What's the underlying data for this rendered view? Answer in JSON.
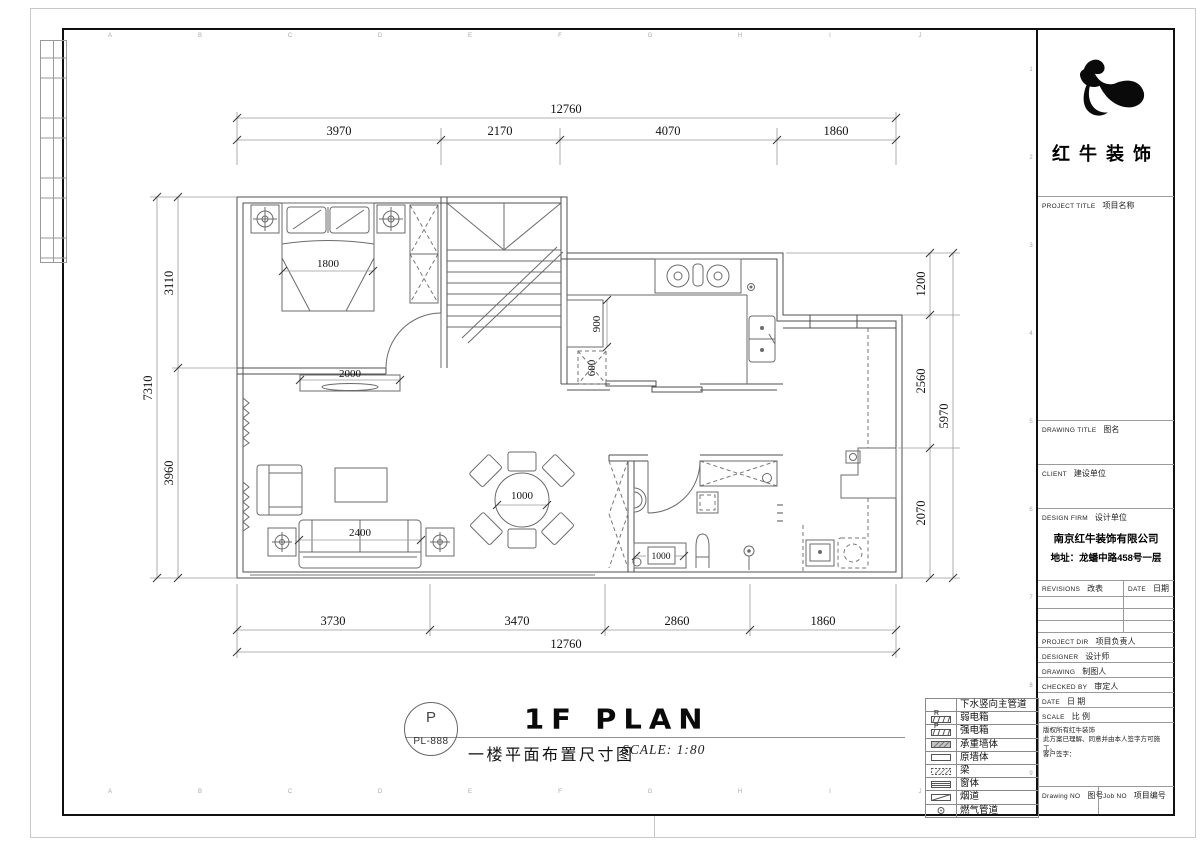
{
  "brand": {
    "name": "红牛装饰"
  },
  "title_block": {
    "project_title_en": "PROJECT TITLE",
    "project_title_cn": "项目名称",
    "drawing_title_en": "DRAWING TITLE",
    "drawing_title_cn": "图名",
    "client_en": "CLIENT",
    "client_cn": "建设单位",
    "design_firm_en": "DESIGN FIRM",
    "design_firm_cn": "设计单位",
    "firm_name": "南京红牛装饰有限公司",
    "firm_address": "地址：龙蟠中路458号一层",
    "revisions_en": "REVISIONS",
    "revisions_cn": "改表",
    "rev_date_en": "DATE",
    "rev_date_cn": "日期",
    "staff_rows": [
      {
        "en": "PROJECT DIR",
        "cn": "项目负责人"
      },
      {
        "en": "DESIGNER",
        "cn": "设计师"
      },
      {
        "en": "DRAWING",
        "cn": "制图人"
      },
      {
        "en": "CHECKED BY",
        "cn": "审定人"
      },
      {
        "en": "DATE",
        "cn": "日 期"
      },
      {
        "en": "SCALE",
        "cn": "比 例"
      }
    ],
    "copyright_line1": "版权所有红牛装饰",
    "copyright_line2": "此方案已理解、同意并由本人签字方可施工。",
    "customer_sign": "客户签字：",
    "drawing_no_en": "Drawing NO",
    "drawing_no_cn": "图号",
    "job_no_en": "Job NO",
    "job_no_cn": "项目编号"
  },
  "legend": {
    "items": [
      {
        "label": "下水竖向主管道",
        "letter": ""
      },
      {
        "label": "弱电箱",
        "letter": "R"
      },
      {
        "label": "强电箱",
        "letter": "P"
      },
      {
        "label": "承重墙体",
        "letter": ""
      },
      {
        "label": "原墙体",
        "letter": ""
      },
      {
        "label": "梁",
        "letter": ""
      },
      {
        "label": "窗体",
        "letter": ""
      },
      {
        "label": "烟道",
        "letter": ""
      },
      {
        "label": "燃气管道",
        "letter": ""
      }
    ]
  },
  "title_bar": {
    "stamp_letter": "P",
    "stamp_code": "PL-888",
    "title_en": "1F PLAN",
    "title_cn": "一楼平面布置尺寸图",
    "scale_label": "SCALE: 1:80"
  },
  "dimensions": {
    "top_total": "12760",
    "top": [
      "3970",
      "2170",
      "4070",
      "1860"
    ],
    "bottom": [
      "3730",
      "3470",
      "2860",
      "1860"
    ],
    "bottom_total": "12760",
    "left": [
      "3110",
      "3960"
    ],
    "left_total": "7310",
    "right": [
      "1200",
      "2560",
      "2070"
    ],
    "right_total": "5970",
    "bed": "1800",
    "tv_wall": "2000",
    "sofa": "2400",
    "dining_table": "1000",
    "kitchen_counter": "900",
    "kitchen_cabinet": "600",
    "bath_vanity": "1000"
  },
  "grid": {
    "letters": [
      "A",
      "B",
      "C",
      "D",
      "E",
      "F",
      "G",
      "H",
      "I",
      "J"
    ],
    "numbers": [
      "1",
      "2",
      "3",
      "4",
      "5",
      "6",
      "7",
      "8",
      "9"
    ]
  },
  "colors": {
    "wall": "#4f4f4f",
    "furniture": "#6b6b6b",
    "dim_line": "#8a8a8a",
    "dim_text": "#111111"
  }
}
